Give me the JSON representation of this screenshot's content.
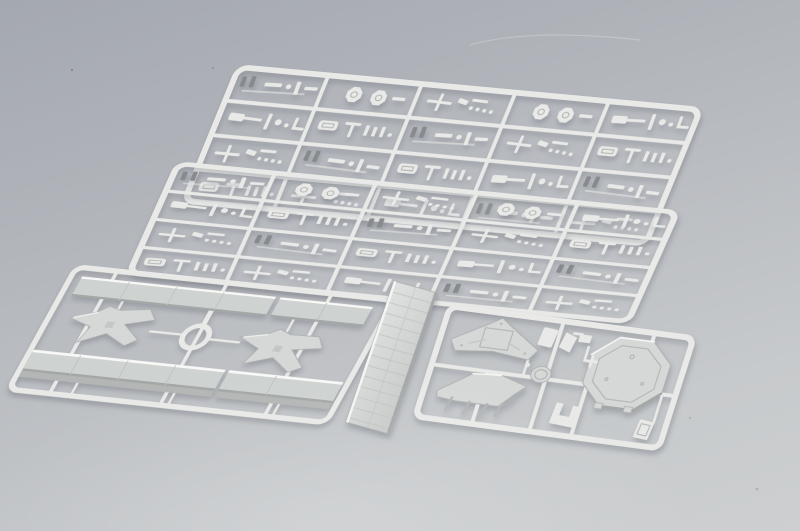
{
  "scene": {
    "type": "product-photo",
    "description": "Overhead studio photograph of five light-gray injection-molded polystyrene sprues of a plastic model warship kit, laid on a neutral gray backdrop with a soft top-to-bottom lighting gradient",
    "sprue_count": 5,
    "material_note": "unpainted light-gray styrene, no visible text or markings",
    "objects": [
      {
        "id": "sprue-fittings-rear",
        "label": "Small-fittings sprue (rear)",
        "detail": "rectangular runner frame with a 5x4 grid of cells holding tiny ship fittings: bollards, winches, gun mounts, davits, hexagonal disc platforms; two darker anchor-like bits in the first cell"
      },
      {
        "id": "sprue-fittings-front",
        "label": "Small-fittings sprue (front duplicate)",
        "detail": "identical duplicate of the rear fittings sprue, offset toward the lower left and overlapping it"
      },
      {
        "id": "sprue-deck-sections",
        "label": "Deck-sections sprue",
        "detail": "two long deck strips (each molded in two segments), two X-shaped platform support parts, and one circular ring at center"
      },
      {
        "id": "deck-plank-piece",
        "label": "Loose planked deck strip",
        "detail": "separate long deck piece with engraved transverse plank lines, lying diagonally between the lower sprues"
      },
      {
        "id": "sprue-superstructure",
        "label": "Superstructure sprue",
        "detail": "octagonal gun platform with raised rim, pointed bridge-deck piece, lower deckhouse piece with support legs, round tub, U-shaped bracket and small housings"
      }
    ]
  },
  "colors": {
    "bg-top": "#a4a8af",
    "bg-upper": "#aeb2b8",
    "bg-mid": "#bbbec2",
    "bg-lower": "#c7cacc",
    "bg-bottom": "#cdcfd0",
    "plastic": "#e9eae8",
    "plastic-hi": "#f8f9f7",
    "plastic-mid": "#d5d8d6",
    "plastic-sh": "#b3b6b4",
    "dark-part": "#878b8e",
    "edge-line": "#aeb1af",
    "seam": "#bfc2c0",
    "deck-face": "#ced2d0",
    "deck-sh": "#a3a7a5",
    "shadow": "rgba(75,80,92,0.35)"
  }
}
